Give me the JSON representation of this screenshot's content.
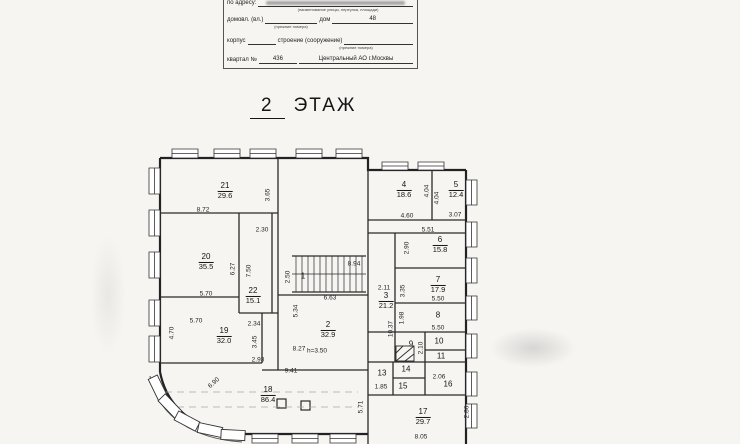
{
  "colors": {
    "ink": "#1b1b1b",
    "paper": "#f6f5f2",
    "dash": "#a8a8a8"
  },
  "header_form": {
    "address_label": "по адресу:",
    "address_caption": "(наименование улицы, переулка, площади)",
    "ownership_label": "домовл. (вл.)",
    "ownership_caption": "(прежние номера)",
    "house_label": "дом",
    "house_value": "48",
    "building_label": "корпус",
    "structure_label": "строение (сооружение)",
    "structure_caption": "(прежние номера)",
    "block_label": "квартал №",
    "block_value": "436",
    "district_value": "Центральный АО г.Москвы"
  },
  "title": {
    "floor_number": "2",
    "floor_word": "ЭТАЖ"
  },
  "plan": {
    "room_labels": [
      {
        "num": "21",
        "area": "29.6",
        "x": 225,
        "y": 191
      },
      {
        "num": "20",
        "area": "35.5",
        "x": 206,
        "y": 262
      },
      {
        "num": "22",
        "area": "15.1",
        "x": 253,
        "y": 296
      },
      {
        "num": "19",
        "area": "32.0",
        "x": 224,
        "y": 336
      },
      {
        "num": "18",
        "area": "86.4",
        "x": 268,
        "y": 395
      },
      {
        "num": "2",
        "area": "32.9",
        "x": 328,
        "y": 330
      },
      {
        "num": "3",
        "area": "21.2",
        "x": 386,
        "y": 301
      },
      {
        "num": "1",
        "area": null,
        "x": 303,
        "y": 277
      },
      {
        "num": "4",
        "area": "18.6",
        "x": 404,
        "y": 190
      },
      {
        "num": "5",
        "area": "12.4",
        "x": 456,
        "y": 190
      },
      {
        "num": "6",
        "area": "15.8",
        "x": 440,
        "y": 245
      },
      {
        "num": "7",
        "area": "17.9",
        "x": 438,
        "y": 285
      },
      {
        "num": "8",
        "area": null,
        "x": 438,
        "y": 316
      },
      {
        "num": "9",
        "area": null,
        "x": 411,
        "y": 345
      },
      {
        "num": "10",
        "area": null,
        "x": 439,
        "y": 342
      },
      {
        "num": "11",
        "area": null,
        "x": 441,
        "y": 357
      },
      {
        "num": "13",
        "area": null,
        "x": 382,
        "y": 374
      },
      {
        "num": "14",
        "area": null,
        "x": 406,
        "y": 370
      },
      {
        "num": "15",
        "area": null,
        "x": 403,
        "y": 387
      },
      {
        "num": "16",
        "area": null,
        "x": 448,
        "y": 385
      },
      {
        "num": "17",
        "area": "29.7",
        "x": 423,
        "y": 417
      }
    ],
    "dim_labels": [
      {
        "text": "8.72",
        "x": 203,
        "y": 210
      },
      {
        "text": "3.65",
        "x": 268,
        "y": 195,
        "rot": -90
      },
      {
        "text": "2.30",
        "x": 262,
        "y": 230
      },
      {
        "text": "4.60",
        "x": 407,
        "y": 216
      },
      {
        "text": "3.07",
        "x": 455,
        "y": 215
      },
      {
        "text": "4.04",
        "x": 427,
        "y": 191,
        "rot": -90
      },
      {
        "text": "4.04",
        "x": 437,
        "y": 198,
        "rot": -90
      },
      {
        "text": "5.51",
        "x": 428,
        "y": 230
      },
      {
        "text": "2.90",
        "x": 407,
        "y": 248,
        "rot": -90
      },
      {
        "text": "6.27",
        "x": 233,
        "y": 269,
        "rot": -90
      },
      {
        "text": "7.50",
        "x": 249,
        "y": 271,
        "rot": -90
      },
      {
        "text": "5.70",
        "x": 206,
        "y": 294
      },
      {
        "text": "5.70",
        "x": 196,
        "y": 321
      },
      {
        "text": "2.50",
        "x": 288,
        "y": 277,
        "rot": -90
      },
      {
        "text": "8.94",
        "x": 354,
        "y": 264
      },
      {
        "text": "6.63",
        "x": 330,
        "y": 298
      },
      {
        "text": "2.11",
        "x": 384,
        "y": 288
      },
      {
        "text": "10.37",
        "x": 391,
        "y": 329,
        "rot": -90
      },
      {
        "text": "3.35",
        "x": 403,
        "y": 291,
        "rot": -90
      },
      {
        "text": "5.50",
        "x": 438,
        "y": 299
      },
      {
        "text": "1.98",
        "x": 402,
        "y": 318,
        "rot": -90
      },
      {
        "text": "5.50",
        "x": 438,
        "y": 328
      },
      {
        "text": "2.10",
        "x": 421,
        "y": 348,
        "rot": -90
      },
      {
        "text": "1.85",
        "x": 381,
        "y": 387
      },
      {
        "text": "2.06",
        "x": 439,
        "y": 377
      },
      {
        "text": "5.34",
        "x": 296,
        "y": 311,
        "rot": -90
      },
      {
        "text": "8.27",
        "x": 299,
        "y": 349
      },
      {
        "text": "h=3.50",
        "x": 317,
        "y": 351
      },
      {
        "text": "2.34",
        "x": 254,
        "y": 324
      },
      {
        "text": "3.45",
        "x": 255,
        "y": 342,
        "rot": -90
      },
      {
        "text": "2.93",
        "x": 258,
        "y": 360
      },
      {
        "text": "4.70",
        "x": 172,
        "y": 333,
        "rot": -90
      },
      {
        "text": "9.41",
        "x": 291,
        "y": 371
      },
      {
        "text": "6.90",
        "x": 214,
        "y": 383,
        "rot": -42
      },
      {
        "text": "5.71",
        "x": 361,
        "y": 407,
        "rot": -90
      },
      {
        "text": "2.86",
        "x": 467,
        "y": 412,
        "rot": -90
      },
      {
        "text": "8.05",
        "x": 421,
        "y": 437
      }
    ]
  }
}
